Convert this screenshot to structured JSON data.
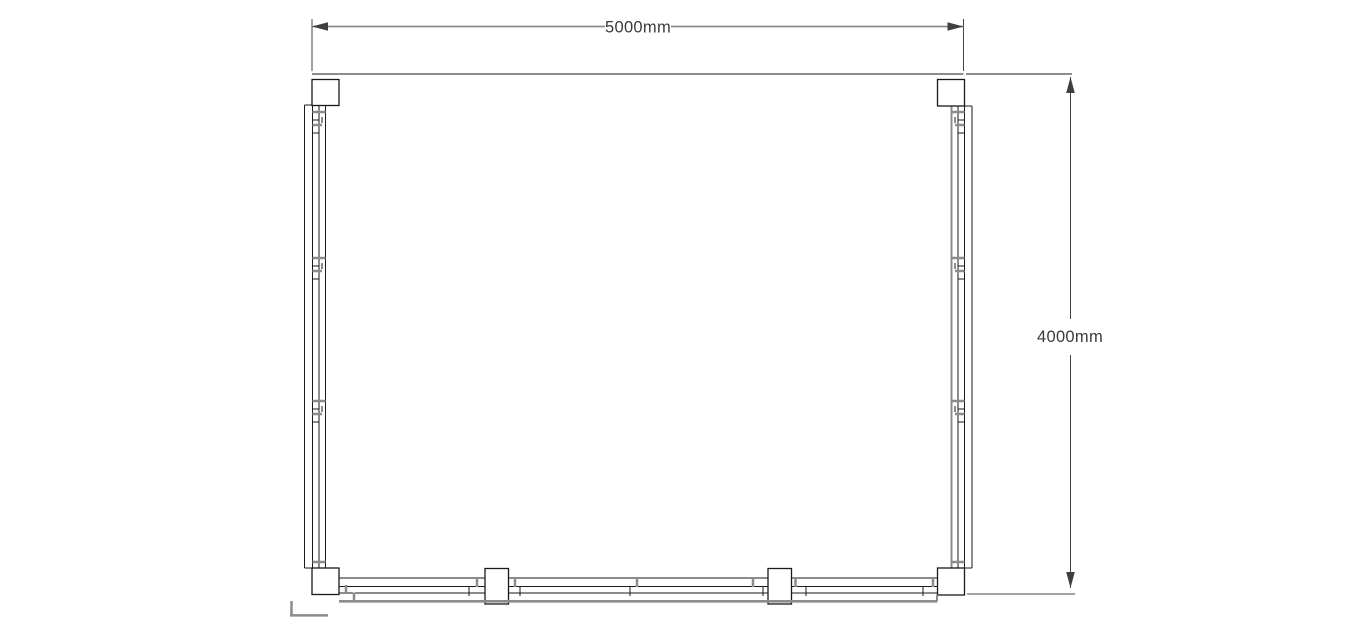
{
  "title": "Floor plan drawing",
  "dimensions": {
    "width": {
      "label": "5000mm",
      "value_mm": 5000
    },
    "height": {
      "label": "4000mm",
      "value_mm": 4000
    }
  },
  "plan": {
    "corner_posts": 4,
    "intermediate_posts_bottom_wall": 2,
    "walls_with_panels": [
      "left",
      "right",
      "bottom"
    ],
    "open_side": "top"
  },
  "colors": {
    "background": "#ffffff",
    "wall_line": "#1a1a1a",
    "overhang_gray": "#8c8c8c",
    "dimension_line_gray": "#8c8c8c",
    "dimension_line_dark": "#444444",
    "dimension_text": "#3a3a3a",
    "arrow": "#3f3f3f",
    "post_fill": "#ffffff"
  }
}
